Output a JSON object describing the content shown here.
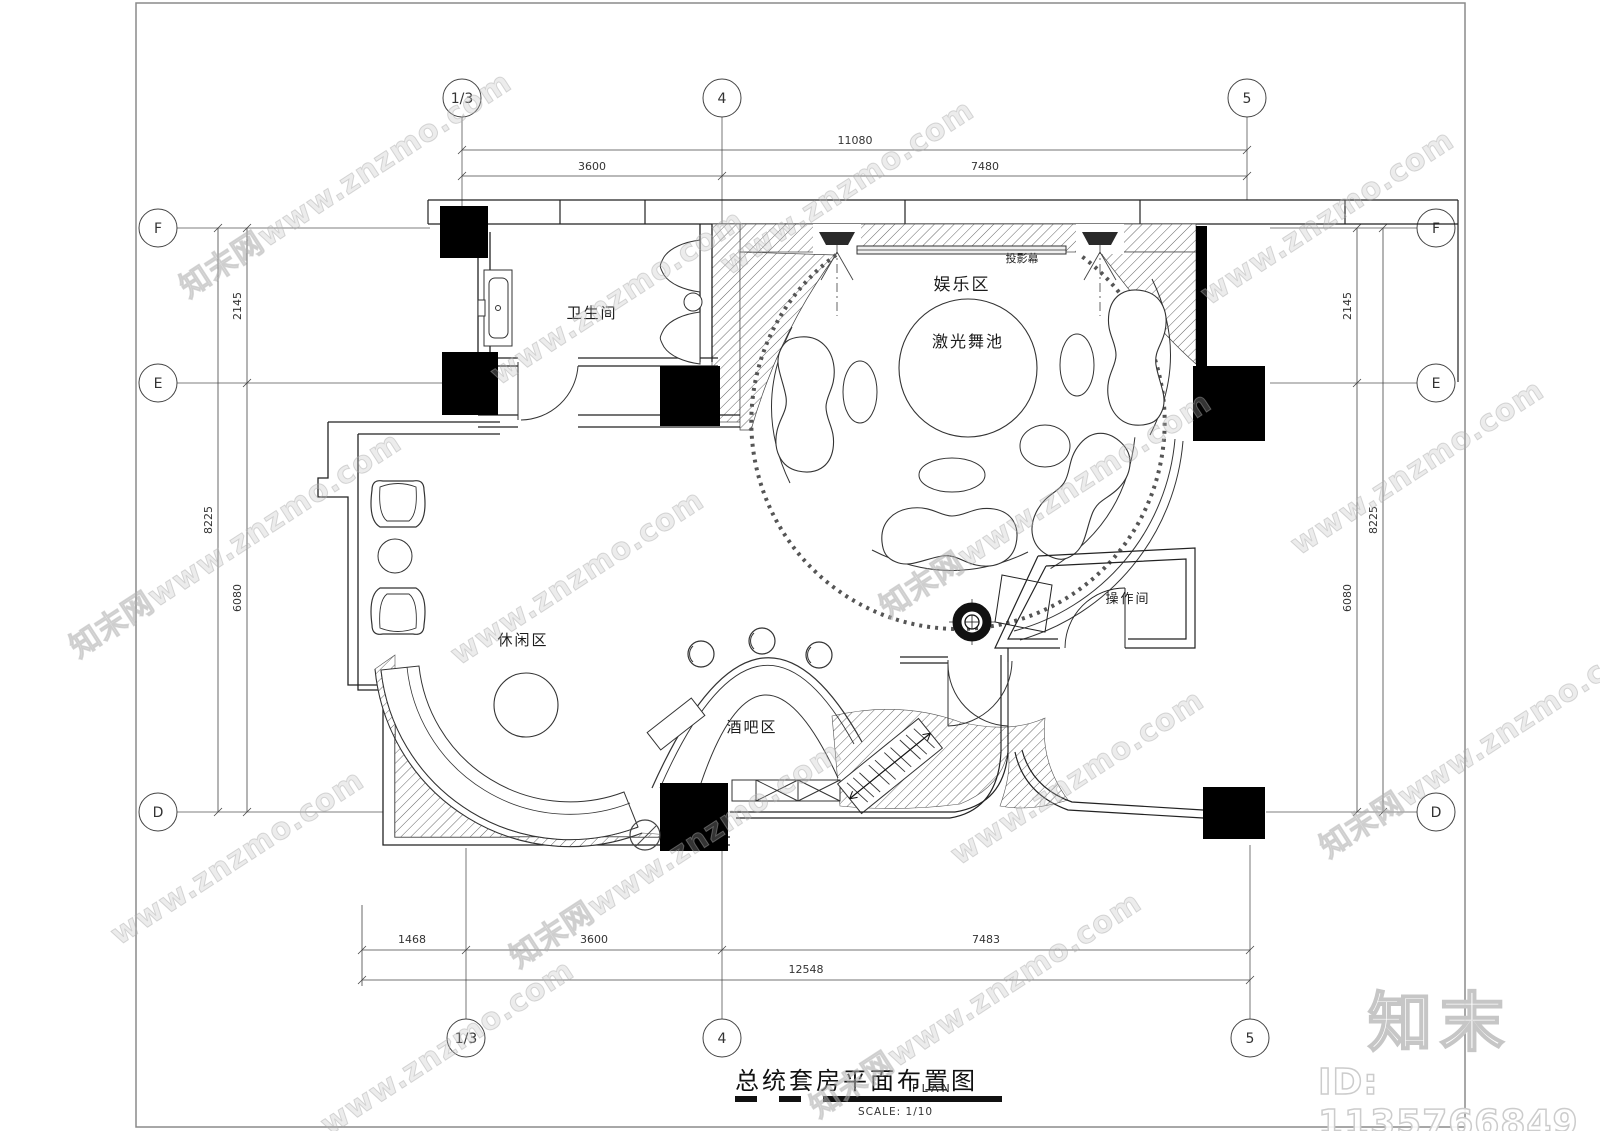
{
  "title_block": {
    "title": "总统套房平面布置图",
    "plan_label": "PLAN",
    "scale_label": "SCALE: 1/10"
  },
  "grid": {
    "cols": [
      {
        "label": "1/3"
      },
      {
        "label": "4"
      },
      {
        "label": "5"
      }
    ],
    "rows": [
      {
        "label": "F"
      },
      {
        "label": "E"
      },
      {
        "label": "D"
      }
    ]
  },
  "dims": {
    "top": {
      "total": "11080",
      "seg1": "3600",
      "seg2": "7480"
    },
    "bottom": {
      "total": "12548",
      "seg1": "1468",
      "seg2": "3600",
      "seg3": "7483"
    },
    "left": {
      "total": "8225",
      "seg1": "2145",
      "seg2": "6080"
    },
    "right": {
      "total": "8225",
      "seg1": "2145",
      "seg2": "6080"
    }
  },
  "rooms": {
    "bathroom": "卫生间",
    "entertainment": "娱乐区",
    "dance_floor": "激光舞池",
    "projection_screen": "投影幕",
    "leisure": "休闲区",
    "bar": "酒吧区",
    "operation": "操作间"
  },
  "watermark": {
    "logo": "知末",
    "id_text": "ID: 1135766849",
    "url": "www.znzmo.com",
    "site": "知末网www.znzmo.com"
  }
}
